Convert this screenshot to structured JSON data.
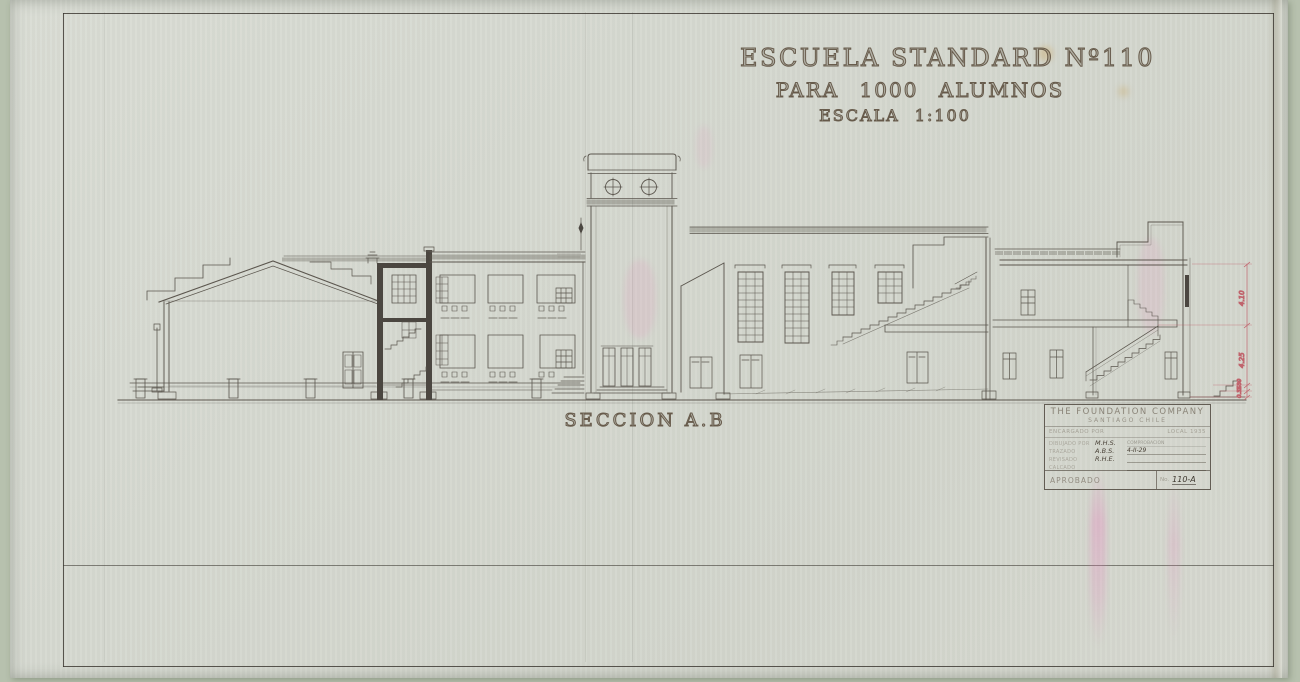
{
  "sheet": {
    "title_line1": "ESCUELA STANDARD Nº110",
    "title_line2": "PARA 1000 ALUMNOS",
    "title_line3": "ESCALA 1:100",
    "section_label": "SECCION A.B"
  },
  "title_block": {
    "company": "THE FOUNDATION COMPANY",
    "location": "SANTIAGO CHILE",
    "row_client_label": "ENCARGADO POR",
    "row_client_value": "LOCAL 1935",
    "rows": [
      {
        "label": "DIBUJADO POR",
        "value": "M.H.S.",
        "note": "COMPROBACION"
      },
      {
        "label": "TRAZADO",
        "value": "A.B.S.",
        "note": "4-II-29"
      },
      {
        "label": "REVISADO",
        "value": "R.H.E.",
        "note": ""
      },
      {
        "label": "CALCADO",
        "value": "",
        "note": ""
      }
    ],
    "approved_label": "APROBADO",
    "number_label": "No.",
    "number_value": "110-A"
  },
  "dimensions": {
    "upper": "4.10",
    "lower": "4.25",
    "small_1": "0.80",
    "small_2": "0.35"
  },
  "colors": {
    "paper": "#d6d9d1",
    "ink": "#4a443c",
    "dimension_red": "#c0636c",
    "stain_pink": "#ec78be"
  }
}
